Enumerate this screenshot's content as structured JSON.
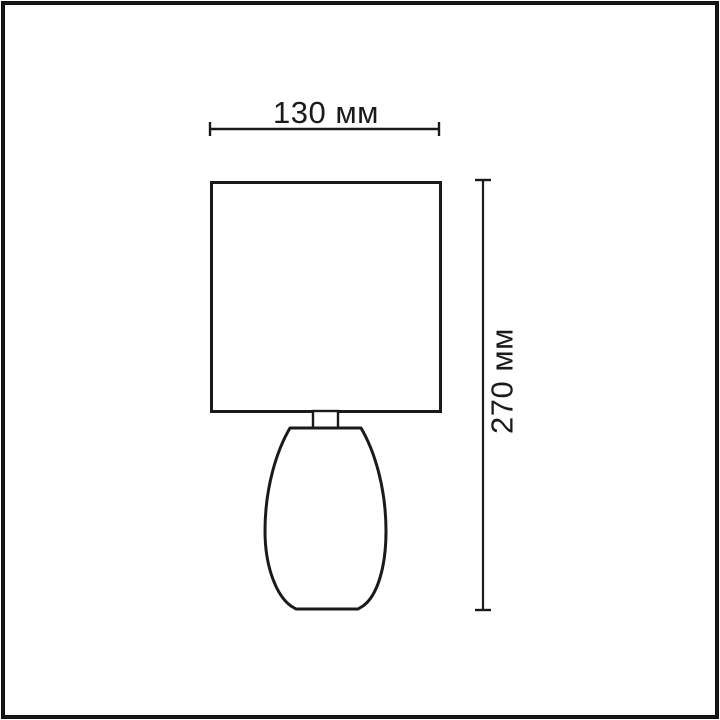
{
  "image": {
    "kind": "lamp dimension drawing",
    "background_color": "#ffffff",
    "frame_color": "#0f0f0f",
    "line_color": "#1a1a1a"
  },
  "dimensions": {
    "width": {
      "label": "130 мм",
      "value_mm": 130
    },
    "height": {
      "label": "270 мм",
      "value_mm": 270
    }
  },
  "product": {
    "parts": [
      "shade",
      "neck",
      "base"
    ]
  }
}
